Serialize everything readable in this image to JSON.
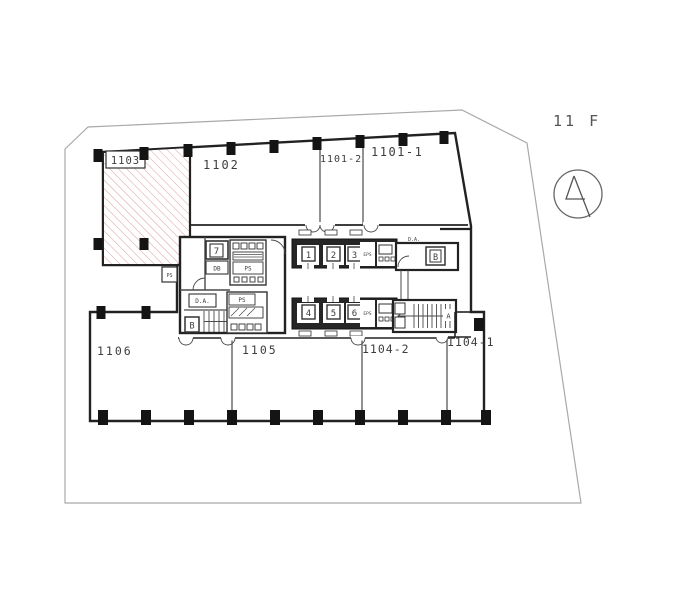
{
  "floor_label": "11 F",
  "rooms": {
    "r1103": "1103",
    "r1102": "1102",
    "r1101_2": "1101-2",
    "r1101_1": "1101-1",
    "r1106": "1106",
    "r1105": "1105",
    "r1104_2": "1104-2",
    "r1104_1": "1104-1"
  },
  "core": {
    "ev1": "1",
    "ev2": "2",
    "ev3": "3",
    "ev4": "4",
    "ev5": "5",
    "ev6": "6",
    "ev7": "7",
    "eps_top": "EPS",
    "eps_bottom": "EPS",
    "db": "DB",
    "ps_upper": "PS",
    "ps_lower": "PS",
    "ps_west": "PS",
    "da_west": "D.A.",
    "da_east": "D.A.",
    "stair_b": "B",
    "stair_a": "A",
    "service_b": "B"
  },
  "icons": {
    "compass": "north-arrow-compass"
  },
  "colors": {
    "wall": "#222222",
    "thin_line": "#4a4a4a",
    "site_boundary": "#a9a9a9",
    "hatch_pink": "#dfa3a3",
    "text": "#3d3d3d",
    "column_fill": "#141414",
    "background": "#ffffff"
  }
}
